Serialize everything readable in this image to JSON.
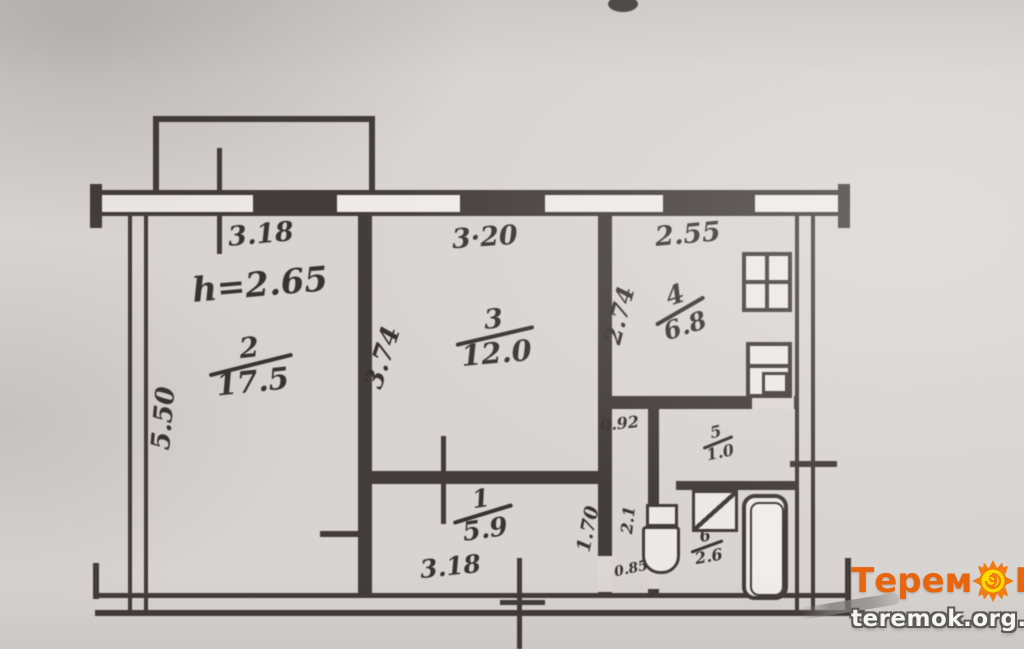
{
  "plan": {
    "ceiling_height": "h=2.65",
    "rooms": [
      {
        "number": "2",
        "area": "17.5"
      },
      {
        "number": "3",
        "area": "12.0"
      },
      {
        "number": "4",
        "area": "6.8"
      },
      {
        "number": "1",
        "area": "5.9"
      },
      {
        "number": "5",
        "area": "1.0"
      },
      {
        "number": "6",
        "area": "2.6"
      }
    ],
    "dimensions": {
      "room2_width": "3.18",
      "room2_depth": "5.50",
      "room3_width": "3·20",
      "room3_depth": "3.74",
      "kitchen_width": "2.55",
      "kitchen_depth": "2.74",
      "hall_width": "3.18",
      "hall_depth": "1.70",
      "corridor_width": "0.92",
      "corridor_depth": "2.1",
      "door_width": "0.85"
    }
  },
  "watermark": {
    "brand_prefix": "Терем",
    "brand_suffix": "К",
    "url": "teremok.org.ua"
  },
  "colors": {
    "ink": "#44403d",
    "paper": "#d8d4d1",
    "brand_orange": "#e8650f",
    "sun_yellow": "#ffd900"
  }
}
